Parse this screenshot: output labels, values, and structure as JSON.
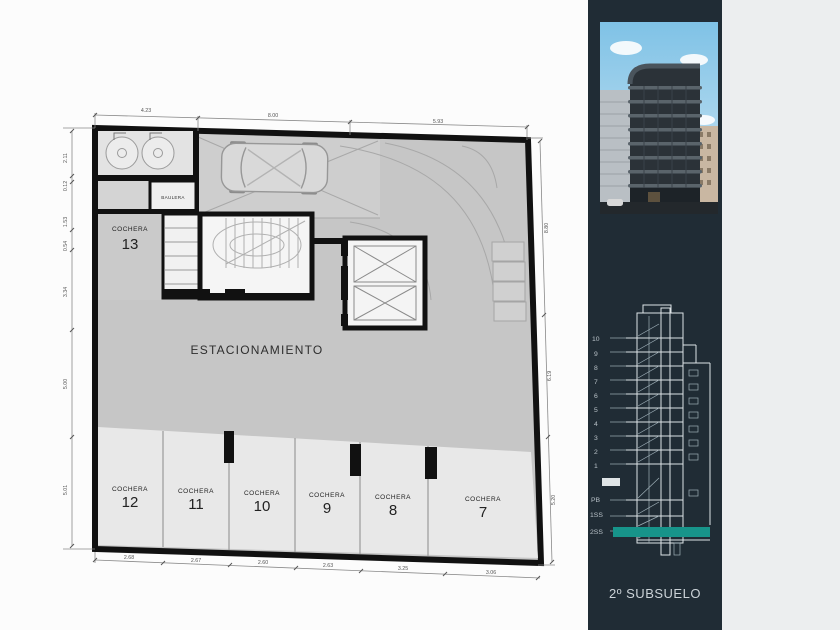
{
  "page": {
    "background": "#fcfcfc",
    "gutter_color": "#eceeef"
  },
  "plan": {
    "title": "ESTACIONAMIENTO",
    "baulera_label": "BAULERA",
    "cochera13": {
      "label": "COCHERA",
      "number": "13"
    },
    "stalls": [
      {
        "label": "COCHERA",
        "number": "12"
      },
      {
        "label": "COCHERA",
        "number": "11"
      },
      {
        "label": "COCHERA",
        "number": "10"
      },
      {
        "label": "COCHERA",
        "number": "9"
      },
      {
        "label": "COCHERA",
        "number": "8"
      },
      {
        "label": "COCHERA",
        "number": "7"
      }
    ],
    "dims": {
      "top": [
        "4.23",
        "8.00",
        "5.93"
      ],
      "left": [
        "2.11",
        "0.12",
        "1.53",
        "0.54",
        "3.34",
        "5.00",
        "5.01"
      ],
      "right": [
        "8.80",
        "6.19",
        "5.20"
      ],
      "bottom": [
        "2.68",
        "2.67",
        "2.60",
        "2.63",
        "3.25",
        "3.06"
      ]
    }
  },
  "sidebar": {
    "background": "#202c35",
    "caption": "2º SUBSUELO",
    "section": {
      "floors": [
        "10",
        "9",
        "8",
        "7",
        "6",
        "5",
        "4",
        "3",
        "2",
        "1",
        "PB",
        "1SS",
        "2SS"
      ],
      "highlighted_floor": "2SS",
      "highlight_color": "#17948a"
    }
  }
}
